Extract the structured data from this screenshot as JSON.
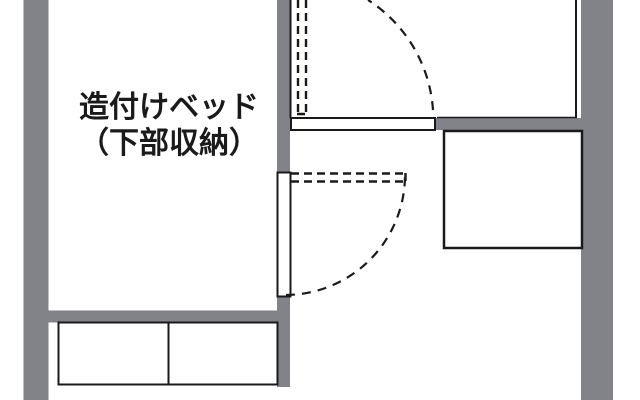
{
  "diagram": {
    "kind_label": "floor-plan",
    "bed_label_line1": "造付けベッド",
    "bed_label_line2": "（下部収納）",
    "colors": {
      "wall": "#828289",
      "ink": "#1a1a1a",
      "background": "#ffffff"
    }
  }
}
